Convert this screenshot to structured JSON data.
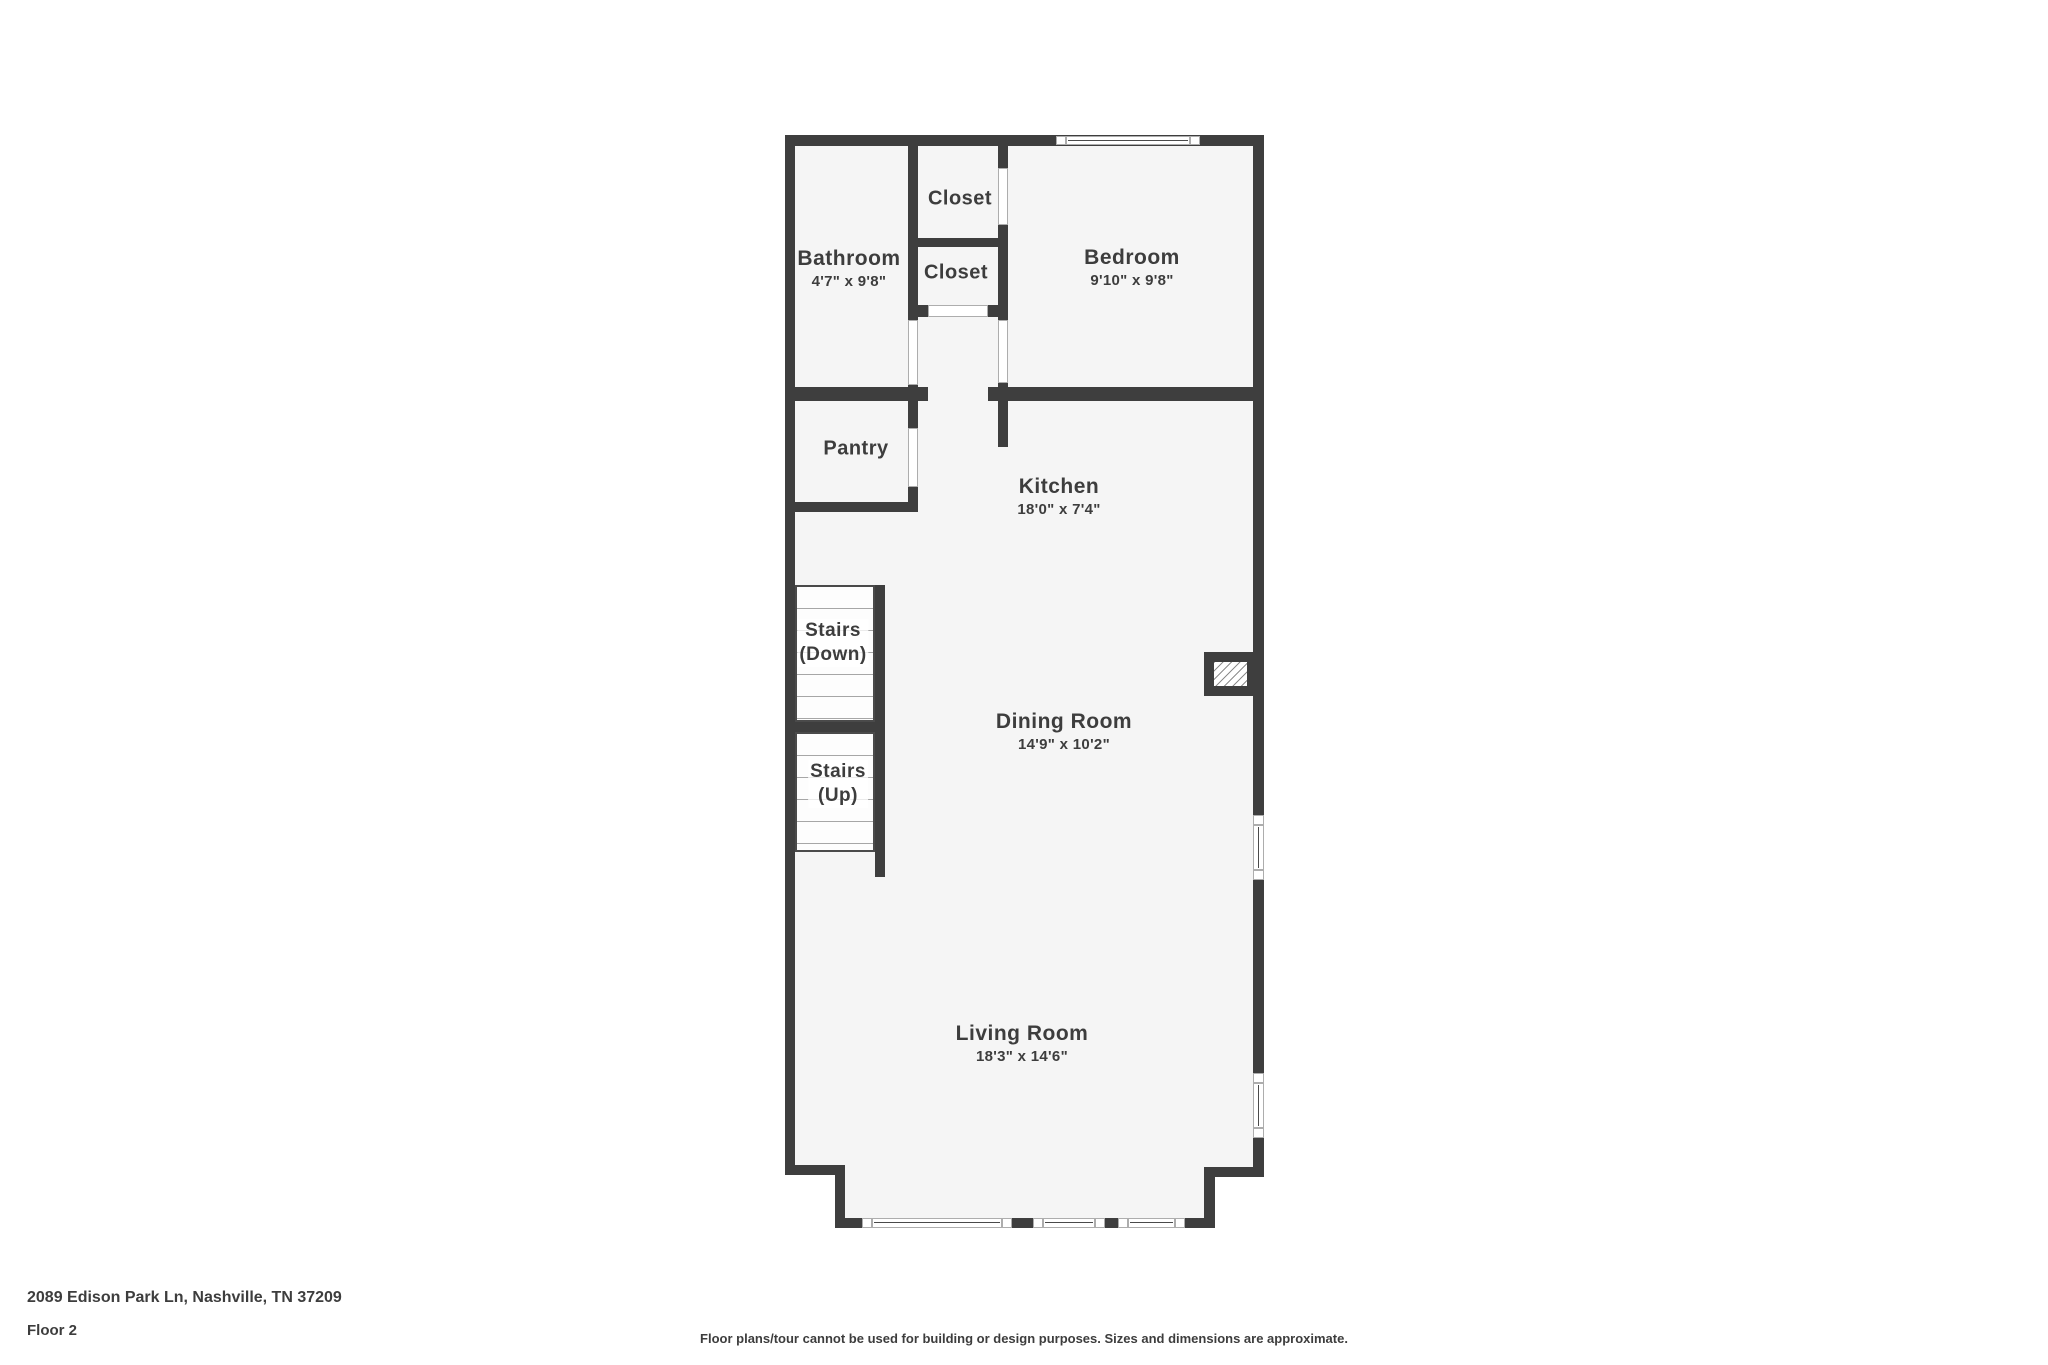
{
  "footer": {
    "address": "2089 Edison Park Ln, Nashville, TN 37209",
    "floor_label": "Floor 2",
    "disclaimer": "Floor plans/tour cannot be used for building or design purposes. Sizes and dimensions are approximate."
  },
  "rooms": {
    "bathroom": {
      "name": "Bathroom",
      "size": "4'7\" x 9'8\""
    },
    "closet_top": {
      "name": "Closet"
    },
    "closet_mid": {
      "name": "Closet"
    },
    "bedroom": {
      "name": "Bedroom",
      "size": "9'10\" x 9'8\""
    },
    "pantry": {
      "name": "Pantry"
    },
    "kitchen": {
      "name": "Kitchen",
      "size": "18'0\" x 7'4\""
    },
    "stairs_down": {
      "line1": "Stairs",
      "line2": "(Down)"
    },
    "stairs_up": {
      "line1": "Stairs",
      "line2": "(Up)"
    },
    "dining": {
      "name": "Dining Room",
      "size": "14'9\" x 10'2\""
    },
    "living": {
      "name": "Living Room",
      "size": "18'3\" x 14'6\""
    }
  },
  "colors": {
    "wall": "#3e3e3e",
    "floor": "#f5f5f5",
    "line": "#adadad",
    "tread": "#a6a6a6",
    "text": "#3d3d3d"
  }
}
